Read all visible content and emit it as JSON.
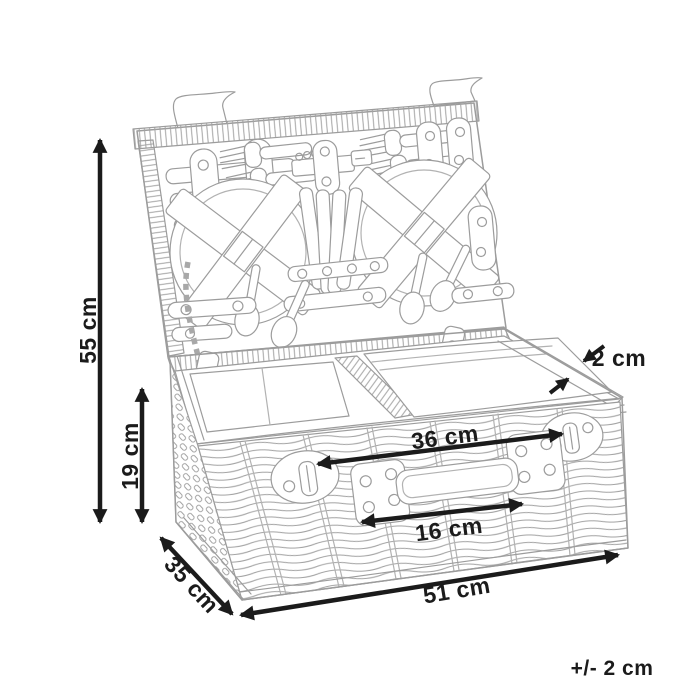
{
  "colors": {
    "background": "#ffffff",
    "line_art": "#9c9c9c",
    "annotations": "#1b1b1b"
  },
  "dimension_labels": {
    "overall_height": "55 cm",
    "body_height": "19 cm",
    "rim_thickness": "2 cm",
    "latch_to_latch": "36 cm",
    "handle": "16 cm",
    "depth": "35 cm",
    "length": "51 cm",
    "tolerance": "+/- 2 cm"
  }
}
